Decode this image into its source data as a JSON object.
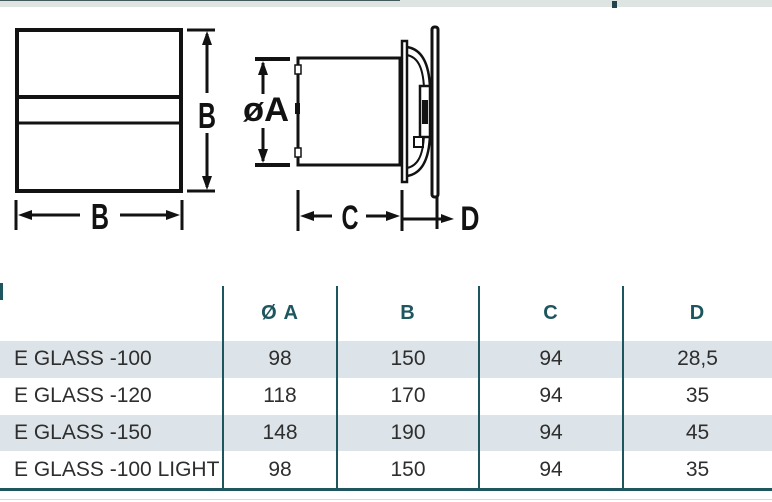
{
  "top_bar": {
    "dash_color": "#22444c"
  },
  "diagram": {
    "front": {
      "height_label": "B",
      "width_label": "B"
    },
    "side": {
      "diameter_label": "øA",
      "depth_label": "C",
      "glass_offset_label": "D"
    }
  },
  "table": {
    "headers": [
      "",
      "Ø A",
      "B",
      "C",
      "D"
    ],
    "rows": [
      {
        "name": "E GLASS -100",
        "a": "98",
        "b": "150",
        "c": "94",
        "d": "28,5"
      },
      {
        "name": "E GLASS -120",
        "a": "118",
        "b": "170",
        "c": "94",
        "d": "35"
      },
      {
        "name": "E GLASS -150",
        "a": "148",
        "b": "190",
        "c": "94",
        "d": "45"
      },
      {
        "name": "E GLASS -100 LIGHT",
        "a": "98",
        "b": "150",
        "c": "94",
        "d": "35"
      }
    ]
  },
  "colors": {
    "teal": "#1d565e",
    "row_shade": "#dce4e9",
    "top_band": "#dde4e2",
    "ink": "#121212"
  }
}
